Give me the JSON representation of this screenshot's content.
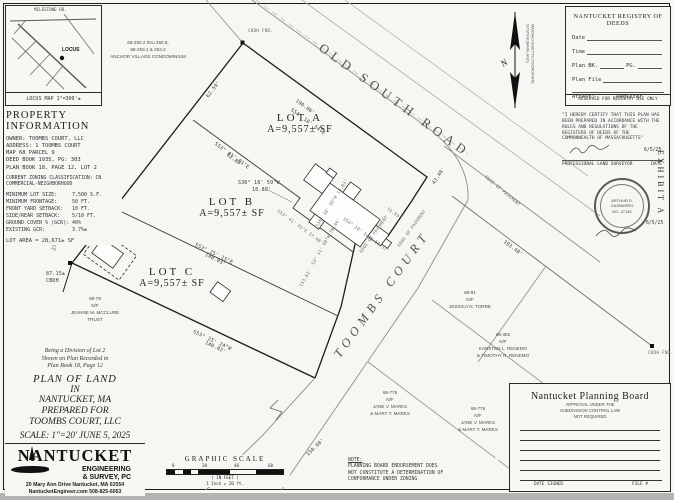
{
  "sheet": {
    "locus": {
      "caption": "LOCUS MAP  1\"=300'±",
      "road": "MILESTONE RD.",
      "label": "LOCUS"
    },
    "registry": {
      "title": "NANTUCKET REGISTRY OF DEEDS",
      "date": "Date",
      "time": "Time",
      "plan_bk": "Plan BK.",
      "pg": "PG.",
      "plan_file": "Plan File",
      "attest": "Attest:",
      "register": "Register",
      "footer": "RESERVED FOR REGISTRY USE ONLY"
    },
    "certification": {
      "body": "\"I HEREBY CERTIFY THAT THIS PLAN HAS BEEN PREPARED IN ACCORDANCE WITH THE RULES AND REGULATIONS OF THE REGISTERS OF DEEDS OF THE COMMONWEALTH OF MASSACHUSETTS\"",
      "surveyor": "PROFESSIONAL LAND SURVEYOR",
      "date_label": "DATE",
      "date": "6/5/25",
      "exhibit": "EXHIBIT A",
      "stamp_line1": "ARTHUR D.",
      "stamp_line2": "GASBARRO",
      "stamp_line3": "NO. 47145",
      "stamp_date": "6/5/25"
    },
    "north": {
      "n": "N",
      "system1": "MASSACHUSETTS COORDINATE",
      "system2": "SYSTEM (MAINLAND)"
    }
  },
  "property_info": {
    "title": "PROPERTY INFORMATION",
    "rows": [
      "OWNER: TOOMBS COURT, LLC",
      "ADDRESS: 1 TOOMBS COURT",
      "MAP 68 PARCEL 9",
      "DEED BOOK 1935, PG: 303",
      "PLAN BOOK 18, PAGE 12, LOT 2"
    ],
    "zoning": [
      "CURRENT ZONING CLASSIFICATION: CN",
      "COMMERCIAL-NEIGHBORHOOD"
    ],
    "metrics": [
      {
        "k": "MINIMUM LOT SIZE:",
        "v": "7,500 S.F."
      },
      {
        "k": "MINIMUM FRONTAGE:",
        "v": "50 FT."
      },
      {
        "k": "FRONT YARD SETBACK:",
        "v": "10 FT."
      },
      {
        "k": "SIDE/REAR SETBACK:",
        "v": "5/10 FT."
      },
      {
        "k": "GROUND COVER % (GCR):",
        "v": "40%"
      },
      {
        "k": "EXISTING GCR:",
        "v": "3.7%±"
      }
    ],
    "lot_area": "LOT AREA = 28,671± SF"
  },
  "plan": {
    "roads": {
      "main": "OLD SOUTH ROAD",
      "side": "TOOMBS COURT"
    },
    "lots": [
      {
        "name": "LOT A",
        "area": "A=9,557± SF"
      },
      {
        "name": "LOT B",
        "area": "A=9,557± SF"
      },
      {
        "name": "LOT C",
        "area": "A=9,557± SF"
      }
    ],
    "abutters": {
      "anchor": [
        "68-250.2 thru 250.8,",
        "68-253.1 & 253.2",
        "ANCHOR VILLAGE CONDOMINIUM"
      ],
      "mcclure": [
        "68-79",
        "N/F",
        "JEANNE M. MCCLURE",
        "TRUST"
      ],
      "torre": [
        "68-91",
        "N/F",
        "JESSICA N. TORRE"
      ],
      "renemo": [
        "68-382",
        "N/F",
        "KARSTEN L. RENEMO",
        "& TIMOTHY R. RENEMO"
      ],
      "marks1": [
        "68-775",
        "N/F",
        "JANE V. MARKS",
        "& MARY T. MARKS"
      ],
      "marks2": [
        "68-775",
        "N/F",
        "JANE V. MARKS",
        "& MARY T. MARKS"
      ]
    },
    "dims": [
      "190.06'",
      "S54° 18' 54\"E",
      "43.40'",
      "62.59'",
      "62.89'",
      "27.45'",
      "87.15±",
      "CBDH",
      "S53° 41' 01\"E",
      "82.80'",
      "S36° 18' 59\"W",
      "10.88'",
      "S53° 25' 15\"E",
      "140.03'",
      "S53° 41' 01\"E  37.98'",
      "S36° 18' 59\"W  14.03'",
      "S54° 18' 54\"E  50.37'",
      "51.03'",
      "S3° 31' 08\"W  78.04'",
      "153.61'",
      "150.00'",
      "193.48'",
      "EDGE OF PAVEMENT",
      "EDGE OF PAVEMENT",
      "EDGE OF PAVEMENT",
      "CBDH FND.",
      "CBDH FND.",
      "CBDH FND.",
      "S53° 25' 24\"W",
      "140.02'"
    ]
  },
  "title_block": {
    "division_note": [
      "Being a Division of Lot 2",
      "Shown on Plan Recorded in",
      "Plan Book 18, Page 12"
    ],
    "l1": "PLAN OF LAND",
    "l2": "IN",
    "l3": "NANTUCKET, MA",
    "l4": "PREPARED FOR",
    "l5": "TOOMBS COURT, LLC",
    "scale_date": "SCALE: 1\"=20'   JUNE 5, 2025",
    "firm": {
      "name": "NANTUCKET",
      "line2": "ENGINEERING",
      "line3": "& SURVEY, PC",
      "address": "20 Mary Ann Drive Nantucket, MA 02554",
      "contact": "NantucketEngineer.com 508-825-6053"
    }
  },
  "scale_bar": {
    "title": "GRAPHIC SCALE",
    "ticks": [
      "0",
      "20",
      "40",
      "60"
    ],
    "feet": "( IN FEET )",
    "inch": "1 Inch = 20 ft."
  },
  "note": {
    "head": "NOTE:",
    "lines": [
      "PLANNING BOARD ENDORSEMENT DOES",
      "NOT CONSTITUTE A DETERMINATION OF",
      "CONFORMANCE UNDER ZONING"
    ]
  },
  "planning_board": {
    "title": "Nantucket Planning Board",
    "subtitle": [
      "APPROVAL UNDER THE",
      "SUBDIVISION CONTROL LAW",
      "NOT REQUIRED"
    ],
    "date_signed": "DATE SIGNED",
    "file_no": "FILE #"
  }
}
